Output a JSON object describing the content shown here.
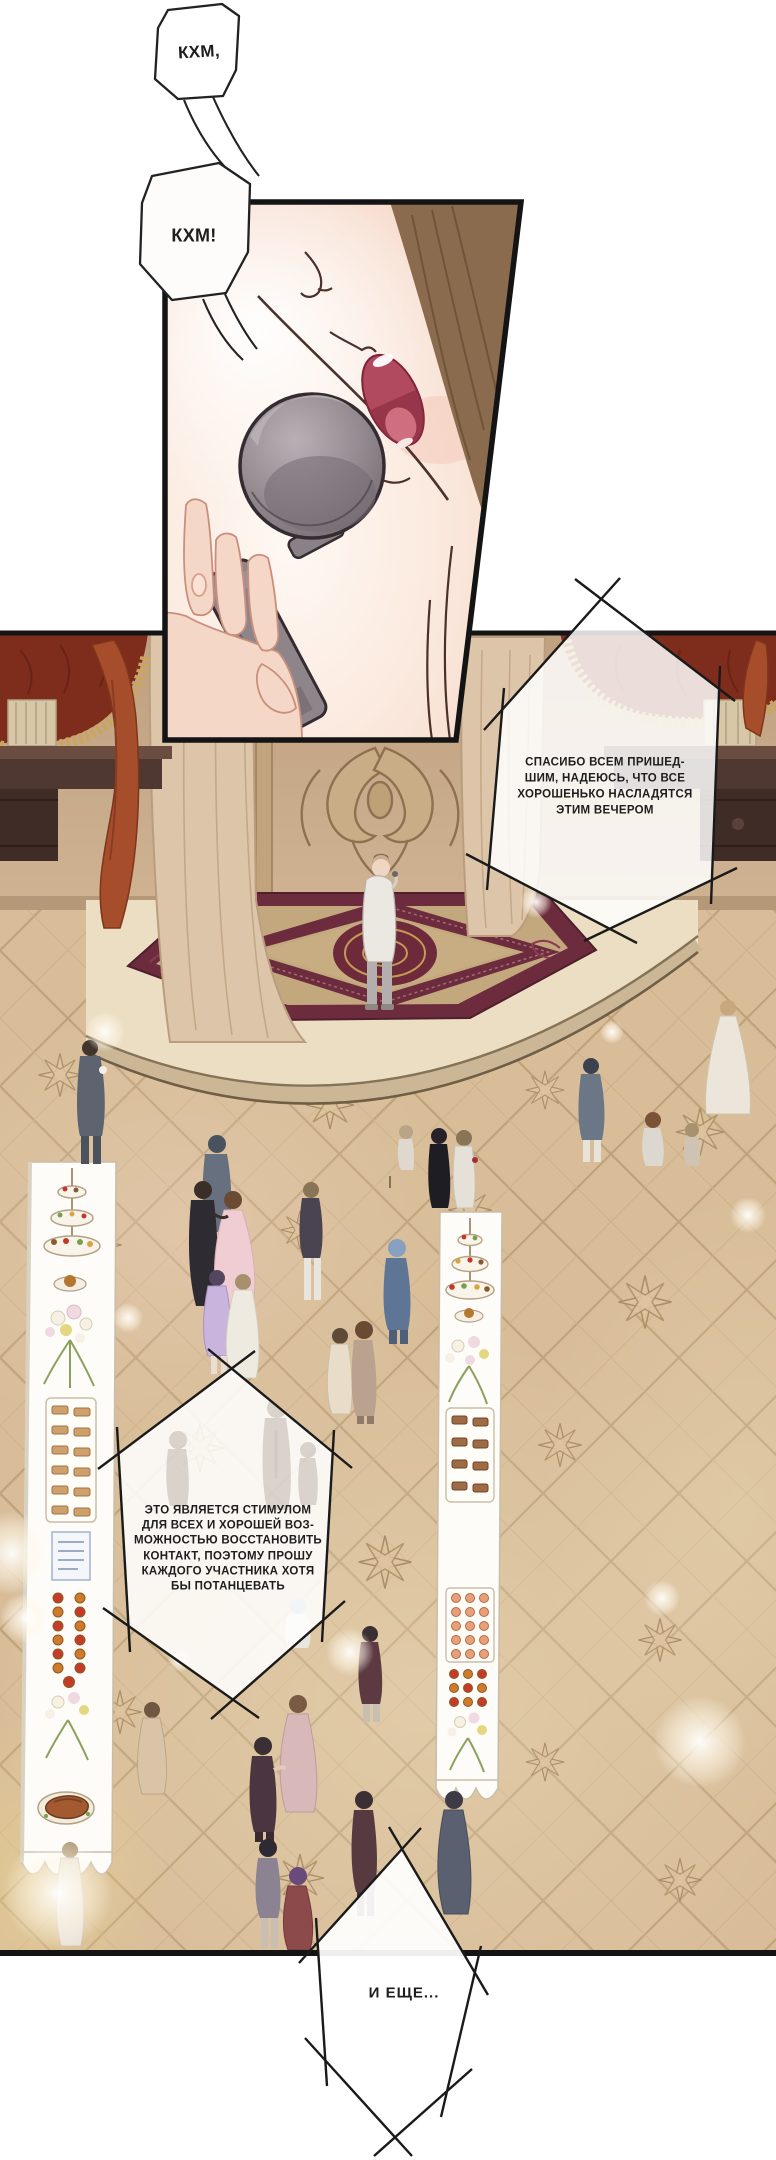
{
  "page_type": "manga-page",
  "language": "ru",
  "bubbles": {
    "cough_small": "КХМ,",
    "cough_big": "КХМ!",
    "thanks": [
      "СПАСИБО ВСЕМ ПРИШЕД-",
      "ШИМ, НАДЕЮСЬ, ЧТО ВСЕ",
      "ХОРОШЕНЬКО НАСЛАДЯТСЯ",
      "ЭТИМ ВЕЧЕРОМ"
    ],
    "incentive": [
      "ЭТО ЯВЛЯЕТСЯ СТИМУЛОМ",
      "ДЛЯ ВСЕХ И ХОРОШЕЙ ВОЗ-",
      "МОЖНОСТЬЮ ВОССТАНОВИТЬ",
      "КОНТАКТ, ПОЭТОМУ ПРОШУ",
      "КАЖДОГО УЧАСТНИКА ХОТЯ",
      "БЫ ПОТАНЦЕВАТЬ"
    ],
    "and_more": "И ЕЩЕ..."
  },
  "colors": {
    "floor_tan": "#d8bd98",
    "tile_line": "#b79b73",
    "wall": "#c9ab88",
    "carpet_maroon": "#6d2c3e",
    "carpet_field": "#c3a87e",
    "canopy_red": "#7e2d1d",
    "fringe_gold": "#c9a55e",
    "drape_red": "#a64e2c",
    "curtain_beige": "#ddc5a9",
    "skin": "#f5d9cb",
    "mouth": "#b24a5f",
    "hair_brown": "#8b6b4e",
    "mic_grey": "#8e858b",
    "ink": "#1a1a1a"
  }
}
